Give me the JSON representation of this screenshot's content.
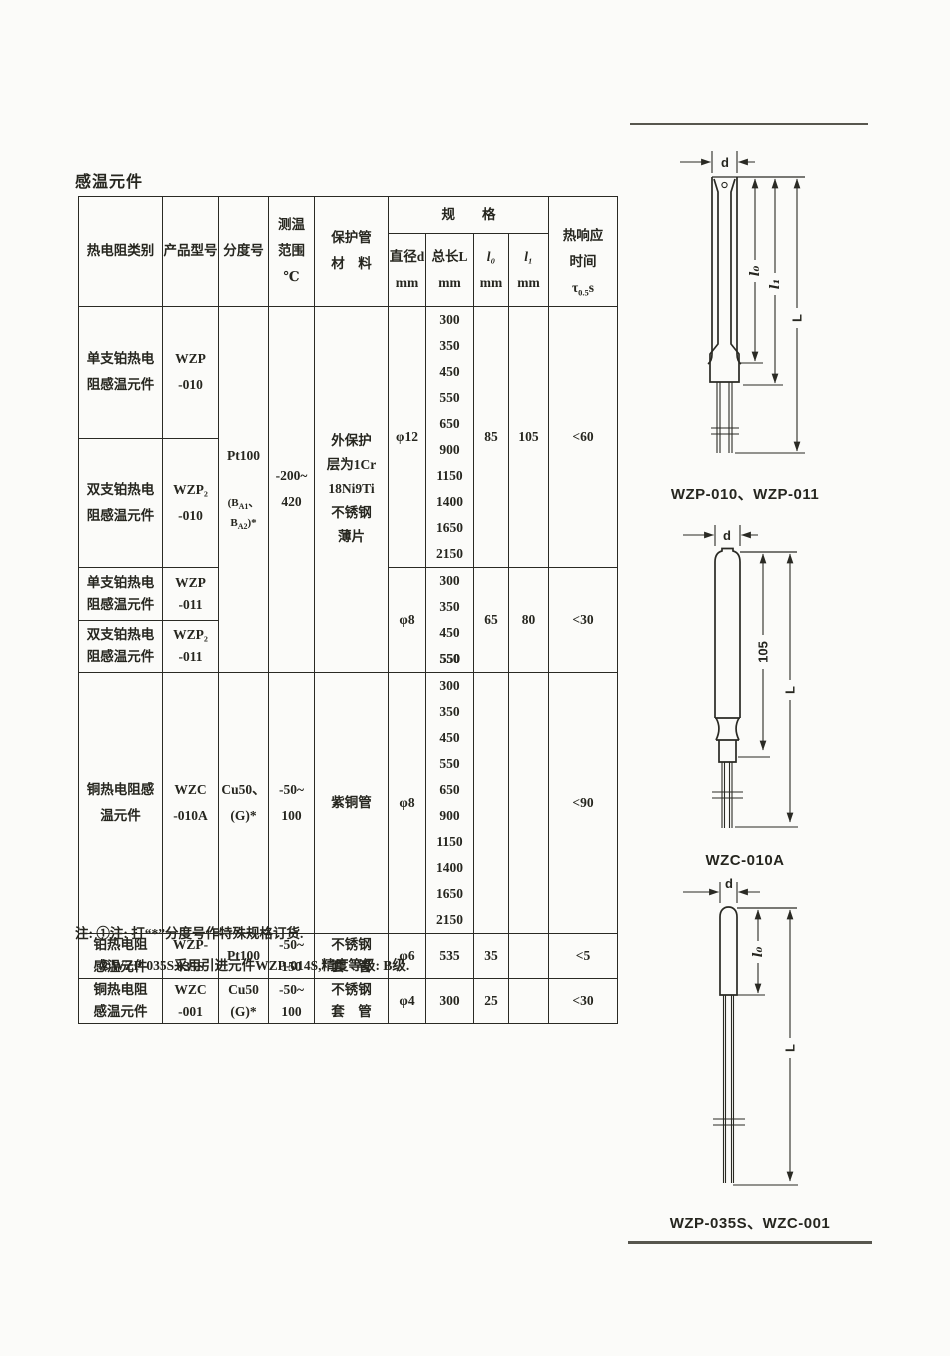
{
  "page": {
    "title": "感温元件"
  },
  "table": {
    "header": {
      "category": "热电阻类别",
      "model": "产品型号",
      "index_no": "分度号",
      "temp_range": "测温\n范围\n℃",
      "sheath": "保护管\n材　料",
      "spec": "规　　格",
      "dia_sym": "直径d",
      "dia_unit": "mm",
      "len_sym": "总长L",
      "len_unit": "mm",
      "l0_sym": "l₀",
      "l0_unit": "mm",
      "l1_sym": "l₁",
      "l1_unit": "mm",
      "resp1": "热响应",
      "resp2": "时间",
      "tau": "τ",
      "tau_sub": "0.5",
      "tau_s": "s"
    },
    "g1": {
      "row1_category": "单支铂热电\n阻感温元件",
      "row1_model": "WZP\n-010",
      "row2_category": "双支铂热电\n阻感温元件",
      "row2_model": "WZP₂\n-010",
      "index_main": "Pt100",
      "index_sub_parts": [
        "(B",
        "A1",
        "、B",
        "A2",
        ")*"
      ],
      "range": "-200~\n420",
      "sheath": "外保护\n层为1Cr\n18Ni9Ti\n不锈钢\n薄片",
      "dia": "φ12",
      "lengths": [
        "300",
        "350",
        "450",
        "550",
        "650",
        "900",
        "1150",
        "1400",
        "1650",
        "2150"
      ],
      "l0": "85",
      "l1": "105",
      "response": "<60"
    },
    "g2": {
      "row1_category": "单支铂热电\n阻感温元件",
      "row1_model": "WZP\n-011",
      "row2_category": "双支铂热电\n阻感温元件",
      "row2_model": "WZP₂\n-011",
      "dia": "φ8",
      "lengths": [
        "300",
        "350",
        "450"
      ],
      "length_last_bold": "550",
      "l0": "65",
      "l1": "80",
      "response": "<30"
    },
    "g3": {
      "category": "铜热电阻感\n温元件",
      "model": "WZC\n-010A",
      "index": "Cu50、\n(G)*",
      "range": "-50~\n100",
      "sheath": "紫铜管",
      "dia": "φ8",
      "lengths": [
        "300",
        "350",
        "450",
        "550",
        "650",
        "900",
        "1150",
        "1400",
        "1650",
        "2150"
      ],
      "l0": "",
      "l1": "",
      "response": "<90"
    },
    "g4": {
      "category": "铂热电阻\n感温元件",
      "model": "WZP-\n035S",
      "index": "Pt100",
      "range": "-50~\n150",
      "sheath": "不锈钢\n套　管",
      "dia": "φ6",
      "length": "535",
      "l0": "35",
      "l1": "",
      "response": "<5"
    },
    "g5": {
      "category": "铜热电阻\n感温元件",
      "model": "WZC\n-001",
      "index": "Cu50\n(G)*",
      "range": "-50~\n100",
      "sheath": "不锈钢\n套　管",
      "dia": "φ4",
      "length": "300",
      "l0": "25",
      "l1": "",
      "response": "<30"
    }
  },
  "notes": {
    "line1": "注: ①注: 打“*”分度号作特殊规格订货.",
    "line2": "②WZP-035S采用引进元件WZP-014S,精度等级: B级."
  },
  "diagrams": {
    "d1": {
      "caption": "WZP-010、WZP-011",
      "dim_d": "d",
      "dim_l0": "l₀",
      "dim_l1": "l₁",
      "dim_L": "L"
    },
    "d2": {
      "caption": "WZC-010A",
      "dim_d": "d",
      "dim_105": "105",
      "dim_L": "L"
    },
    "d3": {
      "caption": "WZP-035S、WZC-001",
      "dim_d": "d",
      "dim_l0": "l₀",
      "dim_L": "L"
    }
  },
  "colors": {
    "ink": "#26261f",
    "paper": "#fbfbf9",
    "rule": "#57564e"
  }
}
